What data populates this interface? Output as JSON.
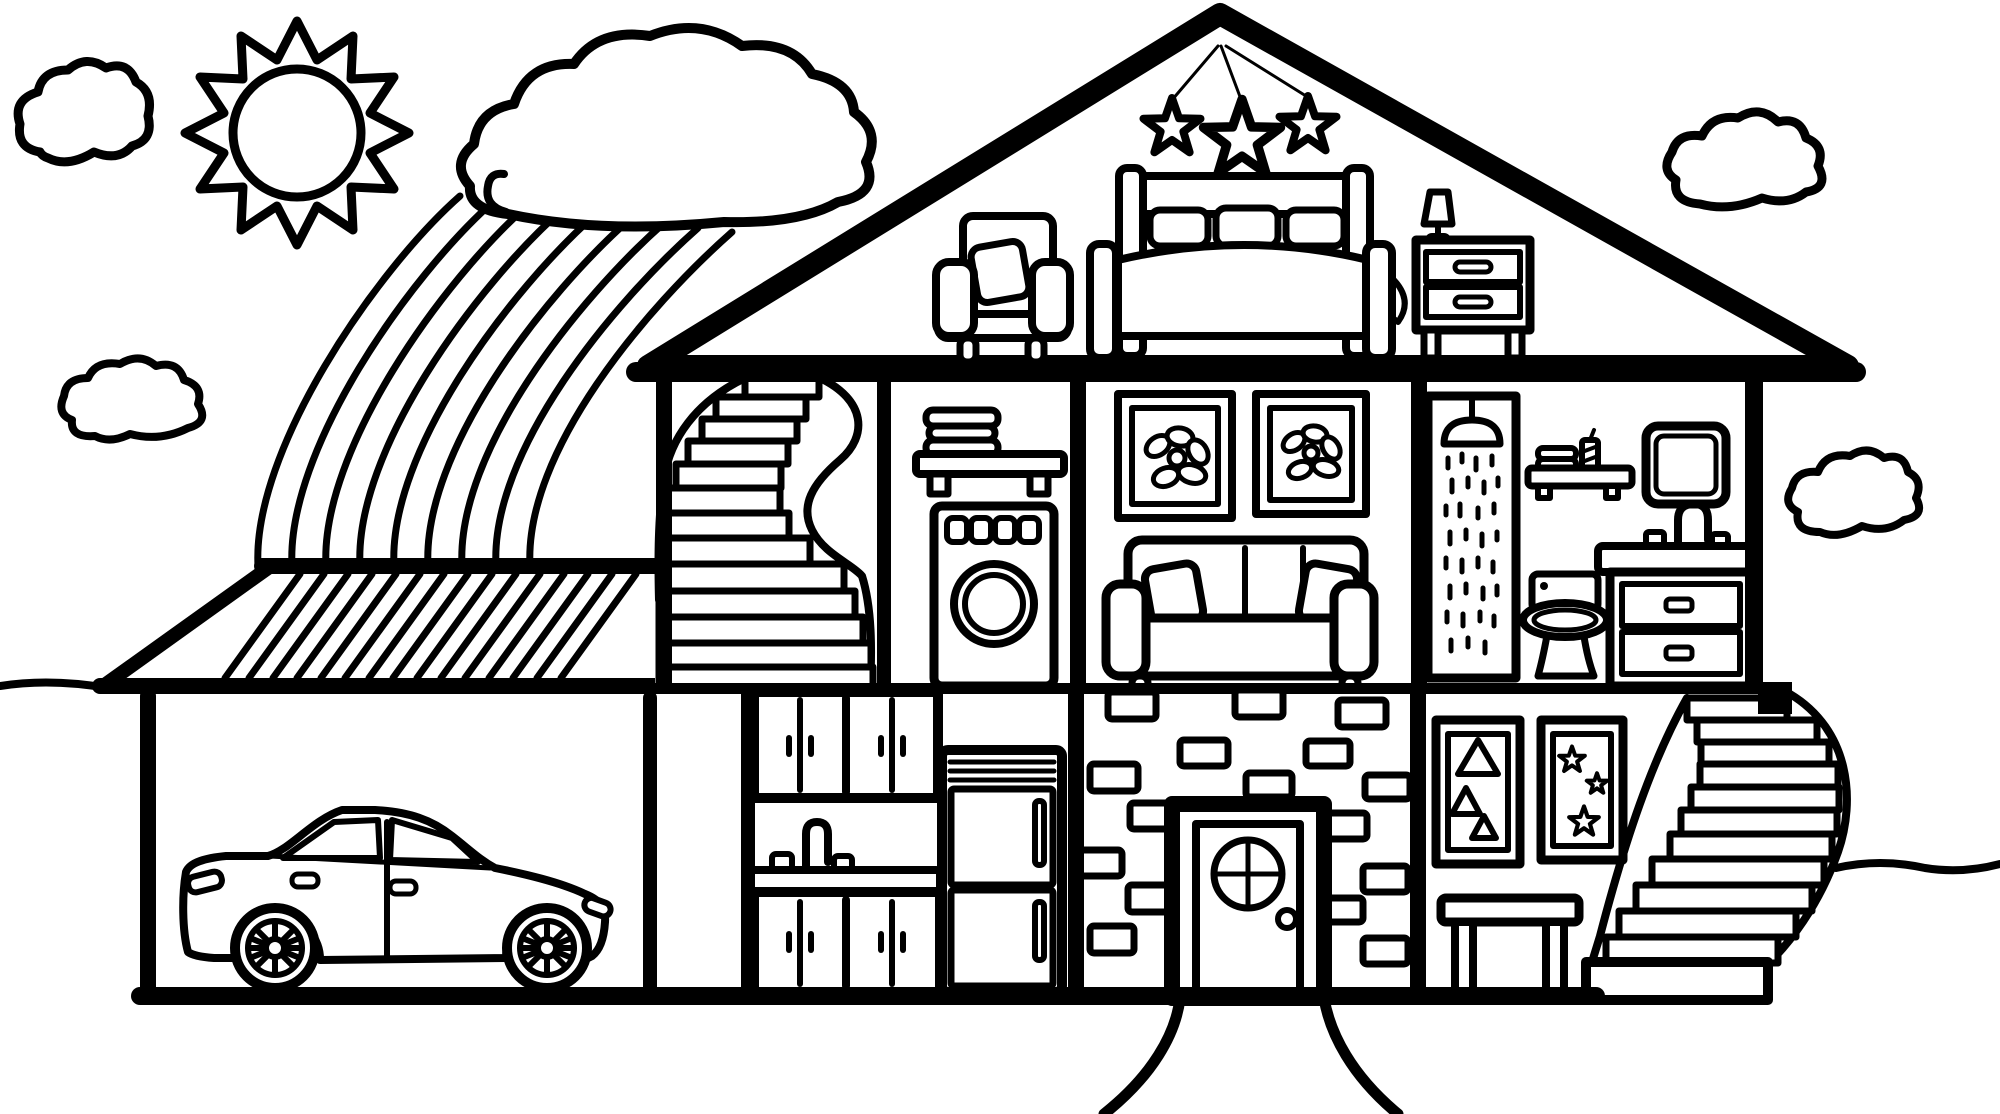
{
  "scene": {
    "label": "Dollhouse cross-section coloring page, black line art on white",
    "type": "coloring-page-line-art",
    "palette": {
      "ink": "#000000",
      "paper": "#ffffff"
    },
    "sky": {
      "sun": {
        "rays": 12,
        "position": "top-left"
      },
      "clouds": [
        {
          "name": "cloud-top-left"
        },
        {
          "name": "cloud-large-above-rainbow"
        },
        {
          "name": "cloud-left-middle"
        },
        {
          "name": "cloud-top-right"
        },
        {
          "name": "cloud-right-middle"
        }
      ],
      "rainbow": {
        "bands": 9,
        "from": "large cloud",
        "to": "garage roof"
      }
    },
    "house": {
      "attic": {
        "hanging_stars": 3,
        "furniture": [
          "armchair with pillow",
          "double bed with three pillows and side posts",
          "nightstand with two drawers and lamp"
        ]
      },
      "second_floor": [
        {
          "room": "stair-hall",
          "feature": "curved spiral staircase",
          "steps": 13
        },
        {
          "room": "laundry",
          "items": [
            "wall shelf with stacked towels",
            "washing machine with 4 buttons and round door"
          ]
        },
        {
          "room": "living-room",
          "items": [
            "framed flower picture",
            "framed flower picture",
            "three-cushion sofa with two pillows"
          ]
        },
        {
          "room": "bathroom",
          "items": [
            "shower with spray",
            "wall shelf with towels and candle",
            "mirror",
            "toilet",
            "vanity sink with faucet and two drawers"
          ]
        }
      ],
      "ground_floor": [
        {
          "room": "garage",
          "roof": "hatched lean-to roof",
          "items": [
            "sedan car with spoked wheels"
          ]
        },
        {
          "room": "kitchen",
          "items": [
            "upper double cabinets",
            "sink with faucet and taps",
            "lower cabinets",
            "refrigerator with two doors"
          ]
        },
        {
          "room": "entry",
          "items": [
            "brick wall",
            "front door with round cross window and doorknob"
          ],
          "bricks": 16
        },
        {
          "room": "play-room",
          "items": [
            "framed picture with 3 triangles",
            "framed picture with 3 stars",
            "bench"
          ]
        },
        {
          "room": "outdoor-stair",
          "feature": "curved spiral staircase",
          "steps": 11
        }
      ],
      "walkway": "two curved path lines flaring from the front door",
      "ground_lines": [
        "left horizon segment",
        "right horizon segment"
      ]
    }
  }
}
